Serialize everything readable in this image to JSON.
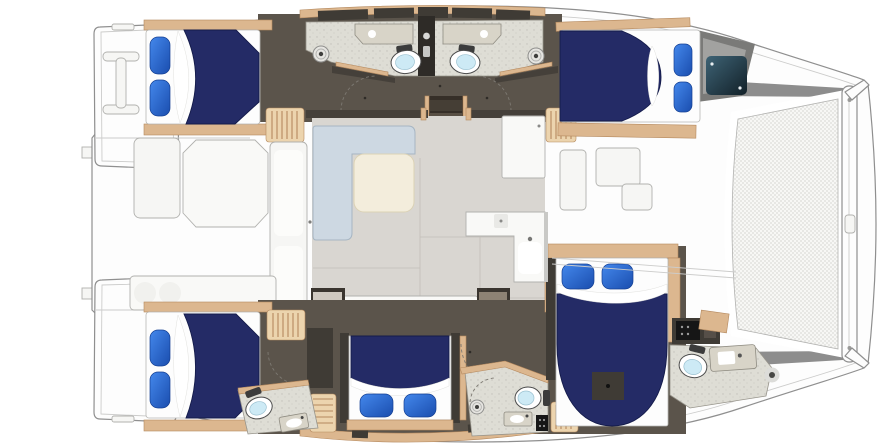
{
  "meta": {
    "description": "Catamaran yacht interior floor plan, top-down illustrated view, bow facing right, five double cabins with navy bedding, five heads, central salon with galley, aft cockpit, bow trampoline",
    "image_type": "illustrated floor plan",
    "visible_text": "none"
  },
  "palette": {
    "background": "#ffffff",
    "hull-stroke": "#8f8f8f",
    "line-light": "#cccccb",
    "deck-white": "#f6f6f4",
    "deck-shadow": "#e6e6e4",
    "salon-floor": "#d9d6d1",
    "salon-seam": "#c2beb8",
    "tile-floor": "#deddd5",
    "dark-floor": "#5b544b",
    "dark-wall": "#45403a",
    "cabinet-dark": "#3f3b35",
    "charcoal": "#2e2b27",
    "wood": "#dcb78f",
    "wood-dark": "#b5895e",
    "wood-light": "#ecd4ae",
    "duvet-navy": "#242b66",
    "duvet-navy-dark": "#141b4a",
    "pillow-blue-1": "#4488ec",
    "pillow-blue-2": "#1a4dae",
    "sofa": "#cdd8e2",
    "sofa-stroke": "#a6b5c3",
    "table-cream": "#f3eddc",
    "table-cream-stroke": "#dbd2b5",
    "counter": "#f9f9f7",
    "counter-stroke": "#b1b1ae",
    "greige": "#d8d4c8",
    "greige-stroke": "#8f8c82",
    "toilet-bowl": "#cdeaf5",
    "toilet-stroke": "#4c4c4c",
    "hatch-teal": "#26404d",
    "hatch-teal-dark": "#122028",
    "gray-band": "#8d8d8d",
    "wedge-gray": "#7a7a78",
    "wedge-gray-light": "#a2a2a0",
    "burner-dark": "#3a3a3a"
  },
  "regions": [
    {
      "name": "stern",
      "features": [
        "port-swim-platform",
        "starboard-swim-platform",
        "davit-frame",
        "transom-steps"
      ]
    },
    {
      "name": "cockpit",
      "features": [
        "octagonal-table",
        "bench-seating",
        "wet-bar-twin-round-sinks",
        "slatted-locker"
      ]
    },
    {
      "name": "salon",
      "features": [
        "l-shaped-sofa",
        "coffee-table",
        "fridge-cabinet",
        "galley-l-counter",
        "galley-sink",
        "stove",
        "companionway-stairs"
      ]
    },
    {
      "name": "port-hull",
      "features": [
        "aft-double-cabin",
        "aft-head-shower-toilet-sink",
        "forward-head-shower-toilet-sink",
        "forward-double-cabin",
        "corridor",
        "stairs",
        "foredeck-hatch-teal"
      ]
    },
    {
      "name": "starboard-hull",
      "features": [
        "aft-double-cabin",
        "aft-head-toilet-sink",
        "mid-double-cabin",
        "mid-head-shower-toilet-sink",
        "forward-double-cabin",
        "forward-head-toilet-sink"
      ]
    },
    {
      "name": "foredeck",
      "features": [
        "deck-hatches",
        "windlass",
        "trampoline",
        "forward-crossbeam",
        "bow-tips"
      ]
    }
  ],
  "inventory": {
    "double-beds": 5,
    "pillows-blue": 10,
    "toilets": 5,
    "bathroom-sinks": 5,
    "shower-drains": 3,
    "cockpit-round-sinks": 2,
    "deck-hatches": 3,
    "teal-skylight-hatches": 1
  }
}
